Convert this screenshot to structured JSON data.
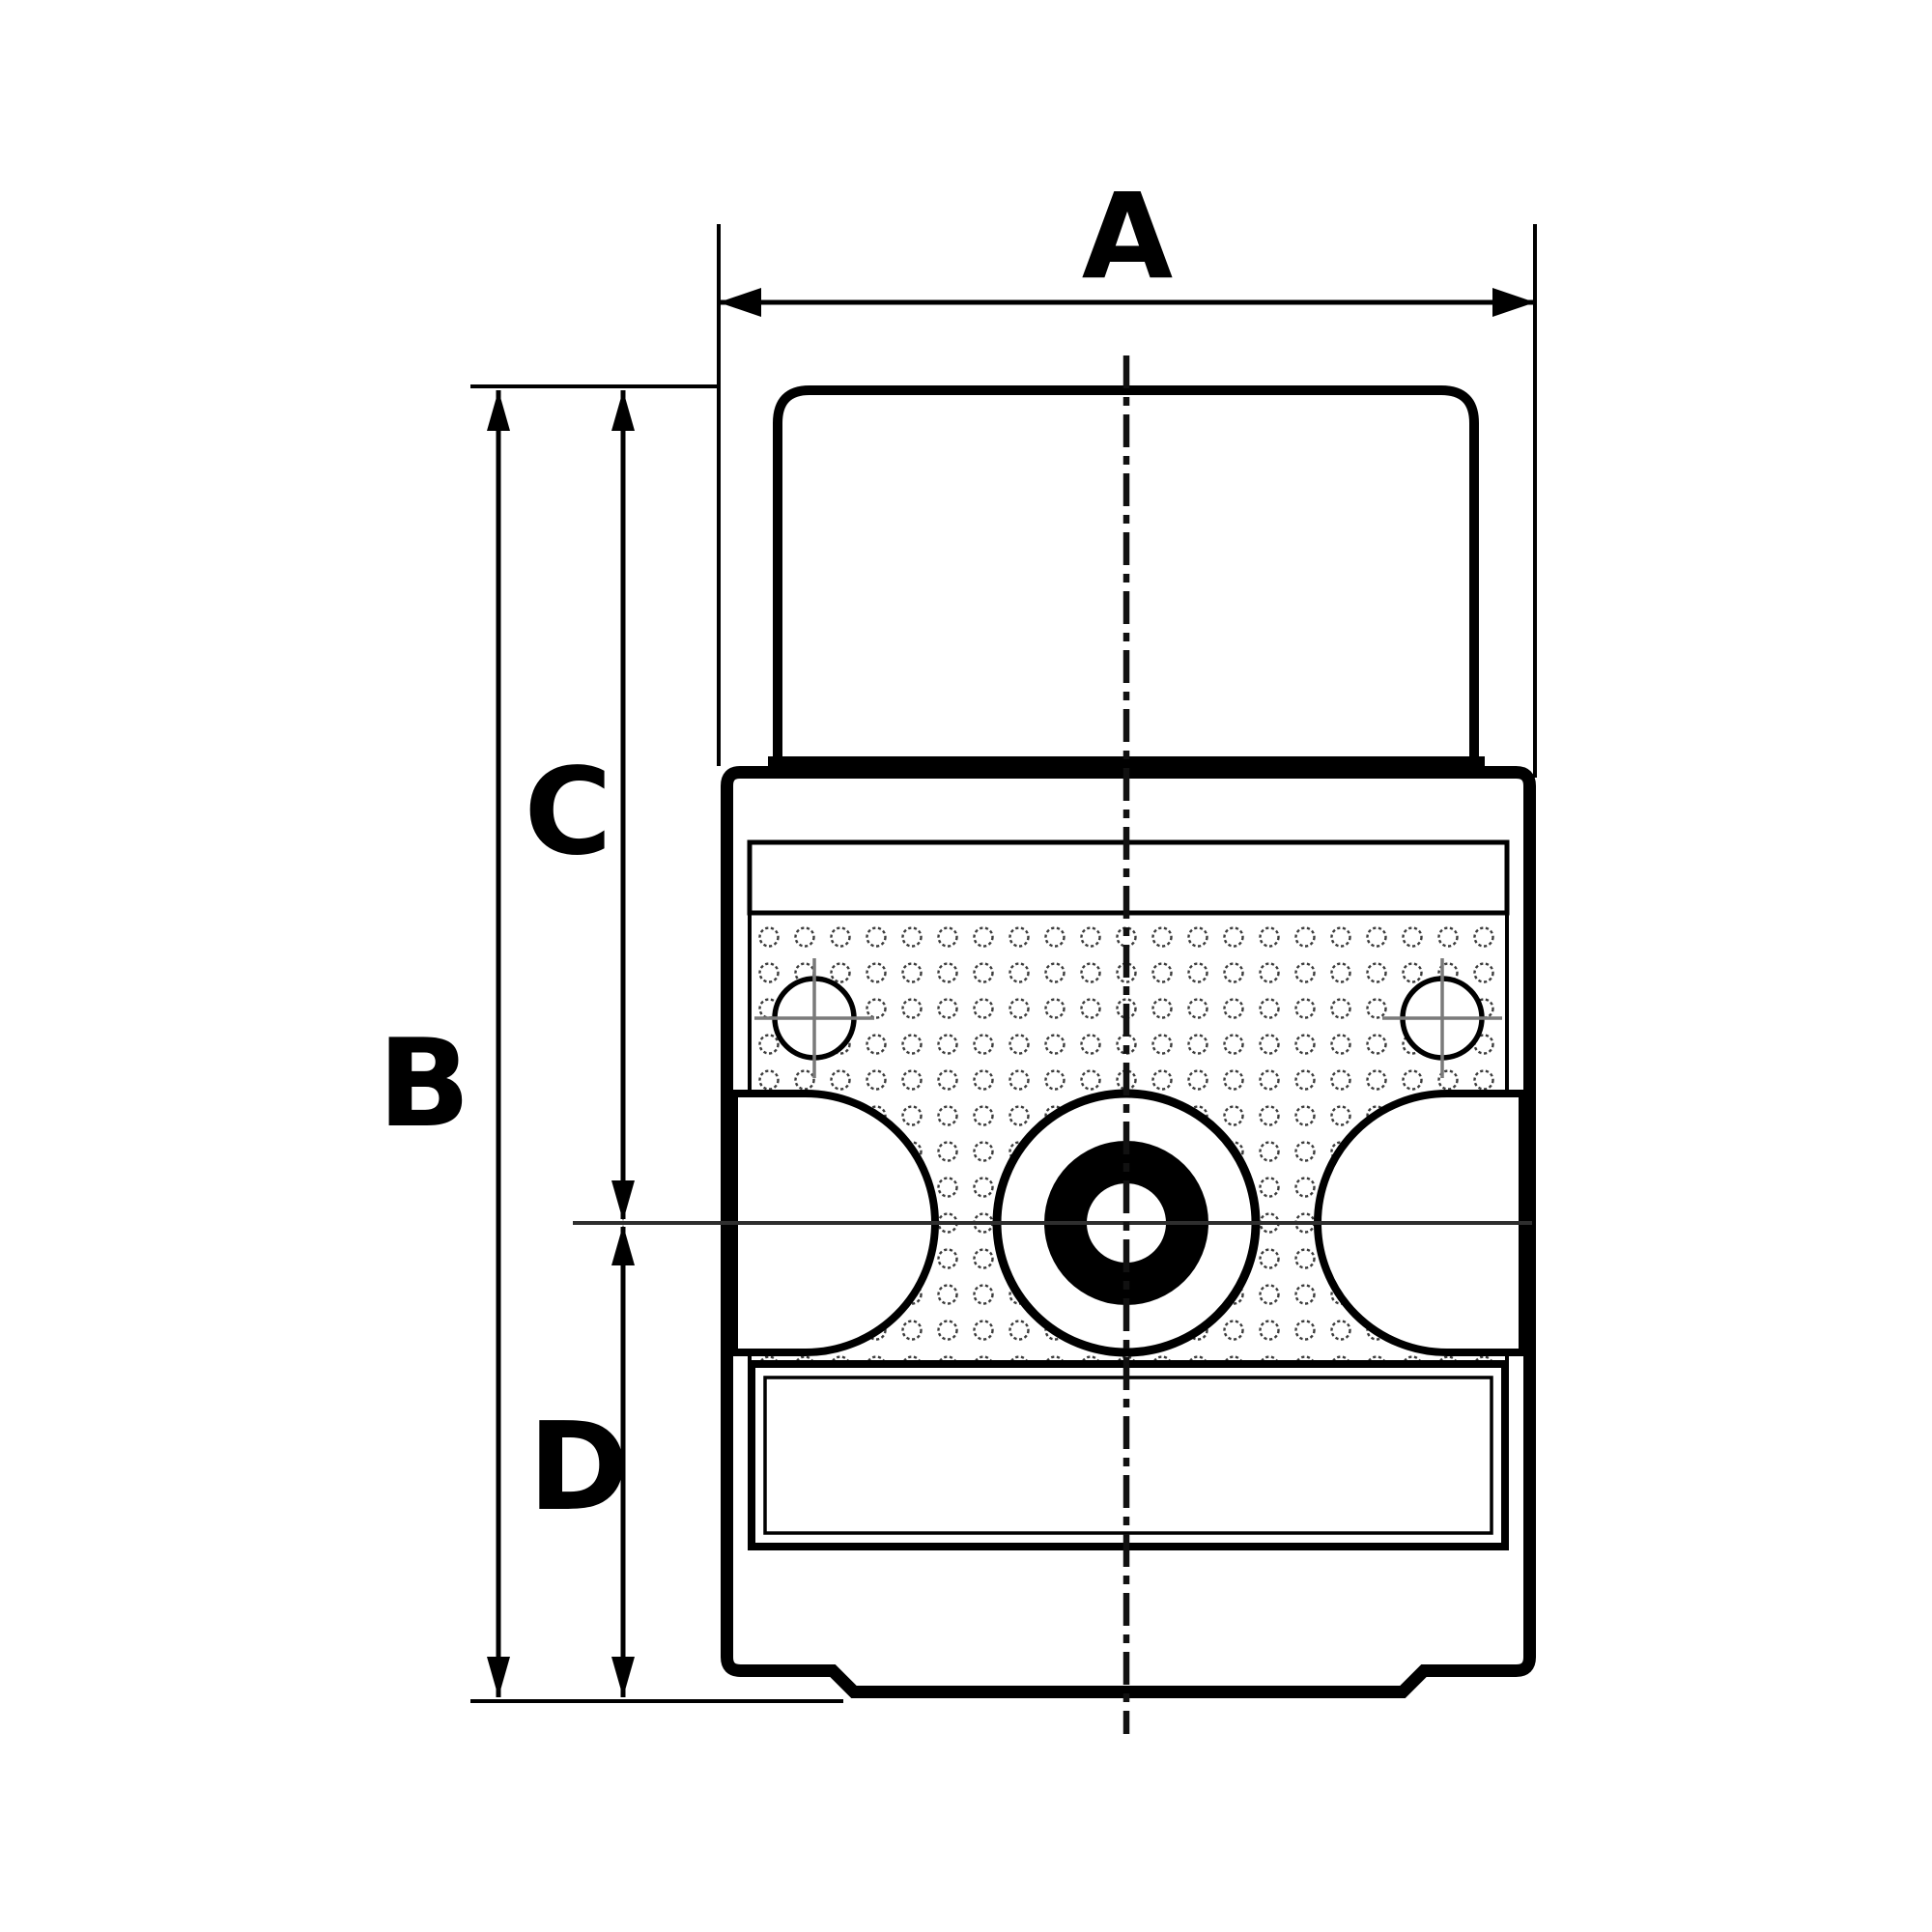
{
  "figure": {
    "kind": "technical-dimension-drawing",
    "background_color": "#ffffff",
    "line_color": "#000000",
    "centerline_color": "#2e2e2e",
    "crosshair_color": "#7a7a7a",
    "perforation_color": "#3c3c3c"
  },
  "dimension_labels": {
    "a": "A",
    "b": "B",
    "c": "C",
    "d": "D"
  }
}
